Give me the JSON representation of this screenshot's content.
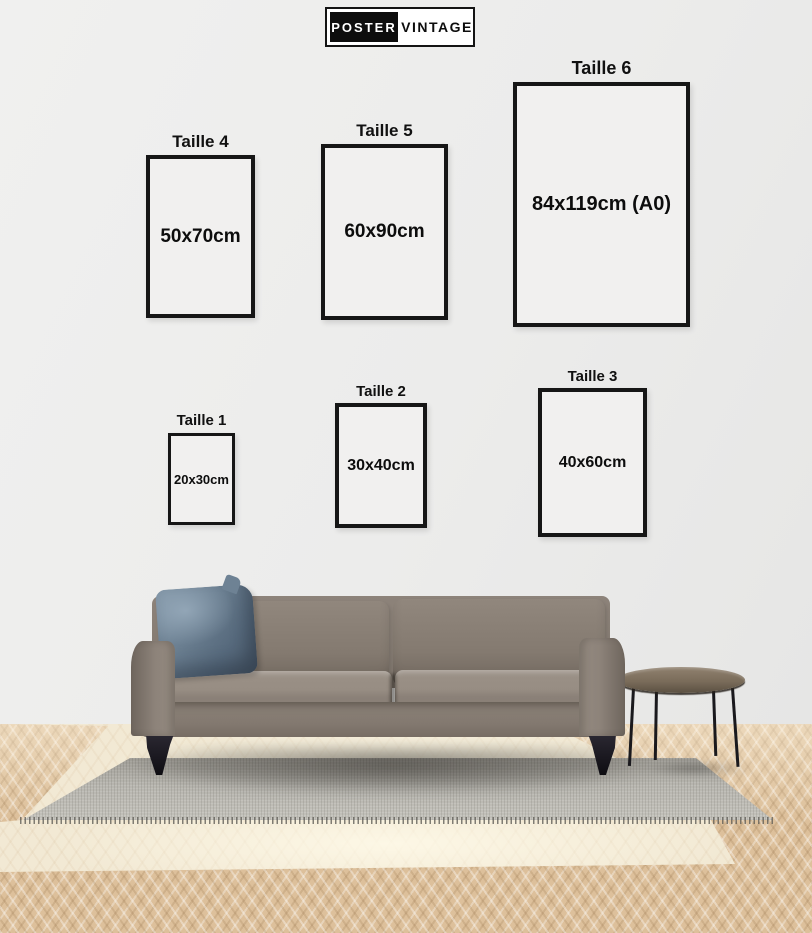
{
  "logo": {
    "primary": "POSTER",
    "secondary": "VINTAGE"
  },
  "frames": [
    {
      "id": "taille-4",
      "label": "Taille 4",
      "size": "50x70cm"
    },
    {
      "id": "taille-5",
      "label": "Taille 5",
      "size": "60x90cm"
    },
    {
      "id": "taille-6",
      "label": "Taille 6",
      "size": "84x119cm (A0)"
    },
    {
      "id": "taille-1",
      "label": "Taille 1",
      "size": "20x30cm"
    },
    {
      "id": "taille-2",
      "label": "Taille 2",
      "size": "30x40cm"
    },
    {
      "id": "taille-3",
      "label": "Taille 3",
      "size": "40x60cm"
    }
  ],
  "colors": {
    "frame_border": "#161616",
    "wall": "#ececeb",
    "sofa": "#8a8076",
    "pillow": "#64788a",
    "rug": "#d8d7d3",
    "floor_wood": "#ddc09b",
    "table_top": "#7a6c5a"
  }
}
